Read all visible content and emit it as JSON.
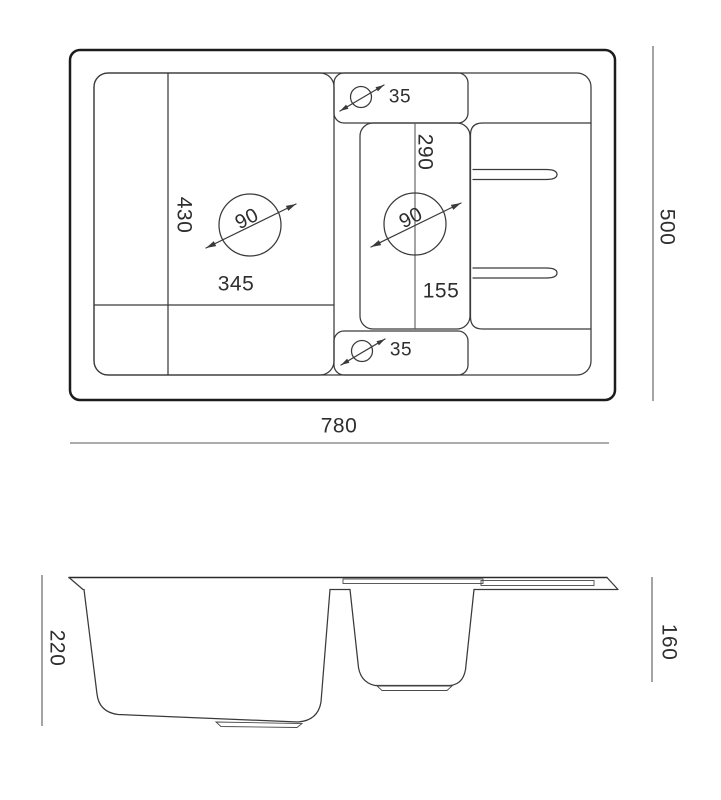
{
  "drawing": {
    "type": "kitchen-sink-dimension-drawing",
    "top_view": {
      "overall_width": "780",
      "overall_depth": "500",
      "main_bowl_length": "430",
      "main_bowl_width": "345",
      "main_drain_diameter": "90",
      "small_bowl_length": "290",
      "small_bowl_width": "155",
      "small_drain_diameter": "90",
      "tap_hole_top_diameter": "35",
      "tap_hole_bottom_diameter": "35"
    },
    "side_view": {
      "main_bowl_depth": "220",
      "small_bowl_depth": "160"
    },
    "colors": {
      "background": "#ffffff",
      "outline": "#1c1c1c",
      "line": "#3a3a3a",
      "dimension_line": "#5a5a5a",
      "text": "#2e2e2e"
    }
  }
}
